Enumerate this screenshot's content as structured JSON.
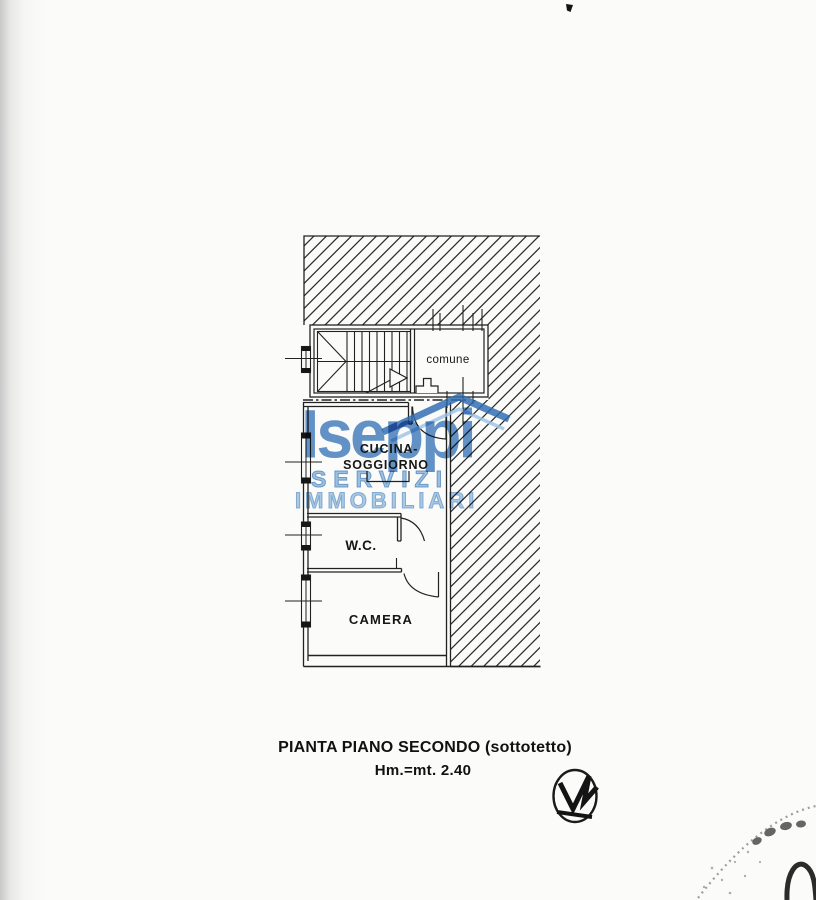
{
  "page": {
    "background": "#fbfbfa",
    "ink_color": "#1f1f1f"
  },
  "plan": {
    "room_comune_label": "comune",
    "room_kitchen_label_line1": "CUCINA-",
    "room_kitchen_label_line2": "SOGGIORNO",
    "room_wc_label": "W.C.",
    "room_bedroom_label": "CAMERA"
  },
  "caption": {
    "title": "PIANTA PIANO SECONDO (sottotetto)",
    "height_note": "Hm.=mt. 2.40"
  },
  "watermark": {
    "brand": "Iseppi",
    "line1": "SERVIZI",
    "line2": "IMMOBILIARI",
    "brand_color": "#3c78bc",
    "outline_color": "#8fb9de"
  }
}
